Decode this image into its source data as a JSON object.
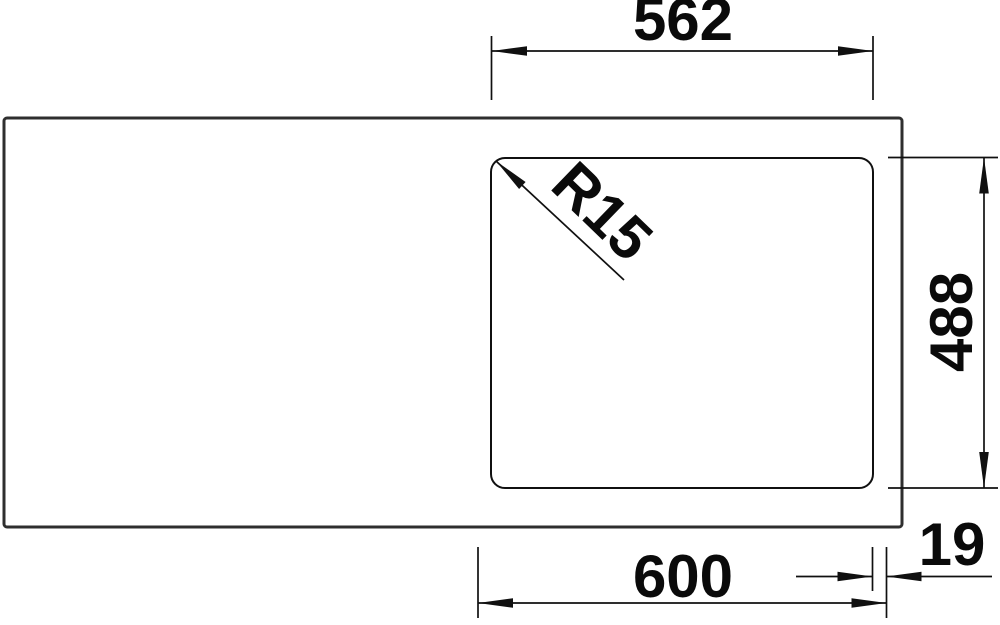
{
  "drawing": {
    "description": "Technical top-view dimension drawing of a kitchen sink with one bowl on the right side and a plain drainer area on the left",
    "colors": {
      "background": "#ffffff",
      "thin_line": "#101010",
      "outline": "#2f2f2f",
      "label_text": "#0a0a0a"
    },
    "labels": {
      "bowl_width": "562",
      "bowl_corner_radius": "R15",
      "bowl_depth": "488",
      "cutout_width": "600",
      "edge_gap": "19"
    }
  }
}
